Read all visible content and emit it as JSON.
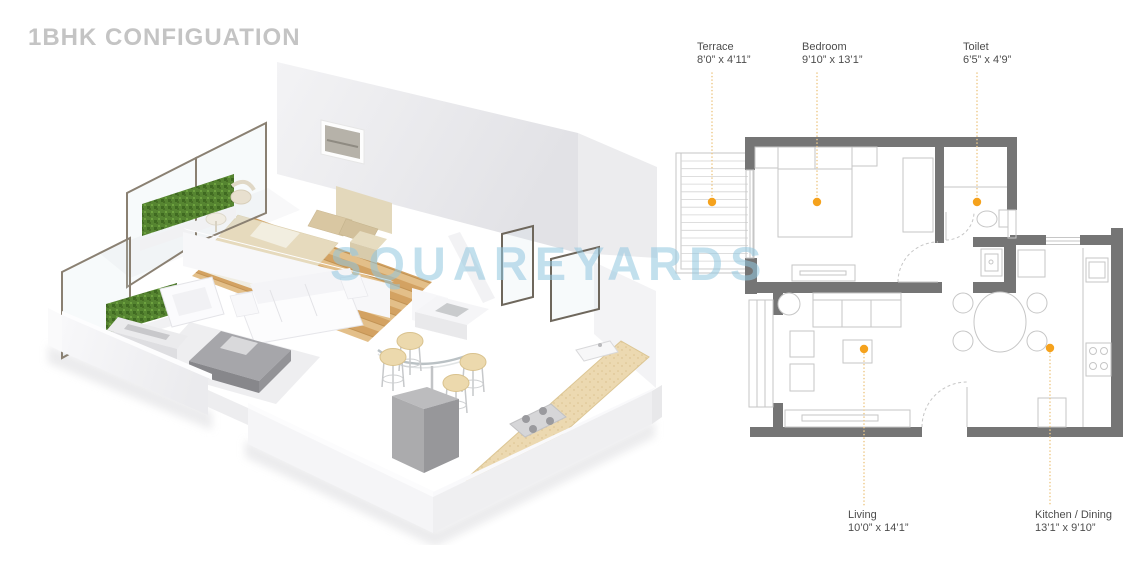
{
  "page": {
    "title": "1BHK CONFIGUATION",
    "watermark": "SQUAREYARDS"
  },
  "colors": {
    "accent_orange": "#F5A21D",
    "leader_line": "#EEC989",
    "wall_gray": "#757575",
    "furniture_line": "#C6C6C6",
    "title_gray": "#C4C4C4",
    "label_text": "#4D4D4D",
    "watermark_blue": "#92C7E0",
    "hedge_green": "#568531",
    "wood_floor": "#D9A967",
    "counter_beige": "#ECD9B1"
  },
  "floor_plan": {
    "rooms": [
      {
        "id": "terrace",
        "name": "Terrace",
        "dimensions": "8’0” x 4’11”"
      },
      {
        "id": "bedroom",
        "name": "Bedroom",
        "dimensions": "9’10” x 13’1”"
      },
      {
        "id": "toilet",
        "name": "Toilet",
        "dimensions": "6’5” x 4’9”"
      },
      {
        "id": "living",
        "name": "Living",
        "dimensions": "10’0” x 14’1”"
      },
      {
        "id": "kitchen_dining",
        "name": "Kitchen / Dining",
        "dimensions": "13’1” x 9’10”"
      }
    ]
  }
}
